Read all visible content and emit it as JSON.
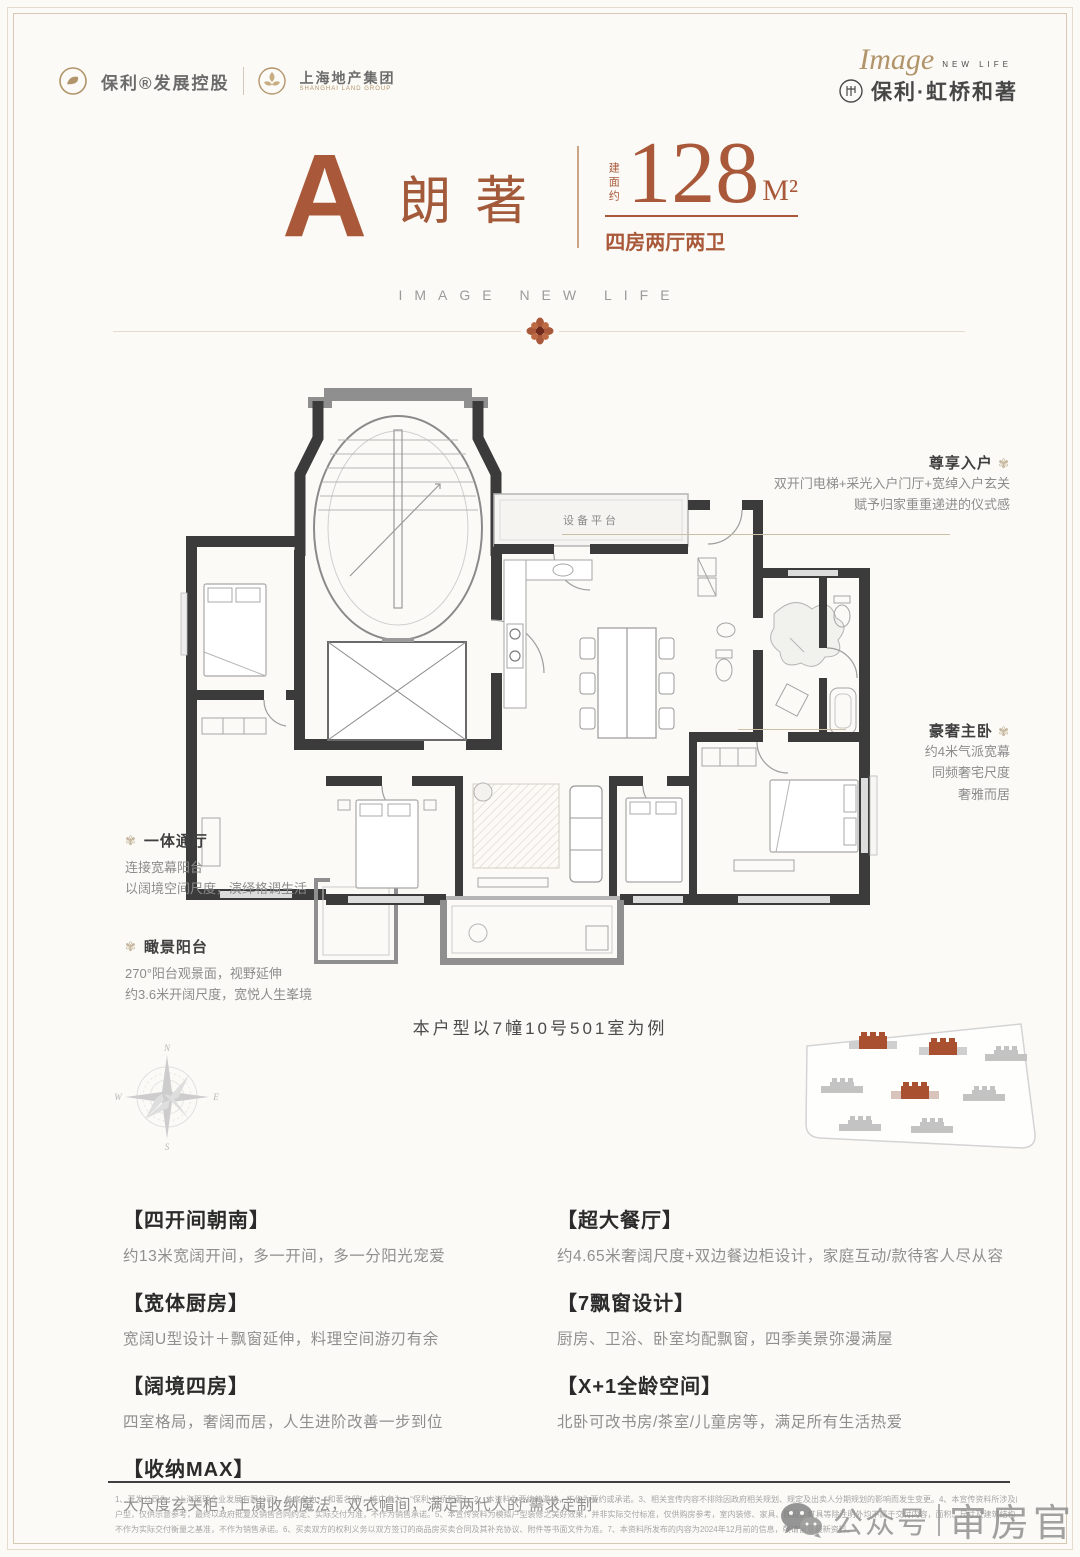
{
  "colors": {
    "accent": "#a9593a",
    "ink": "#3a3a3a",
    "muted": "#8f8f8f",
    "gold": "#b2946a",
    "wall": "#3b3b3b"
  },
  "icons": {
    "callout_bullet": "✾",
    "poly_logo_icon": "gold-swirl-circle",
    "shanghai_land_icon": "gold-flower-circle",
    "project_logo_icon": "ring-seal",
    "wechat_icon": "chat-bubbles",
    "compass_icon": "compass-rose",
    "divider_flower_icon": "rosette"
  },
  "header": {
    "brand1": "保利®发展控股",
    "brand2": "上海地产集团",
    "brand2_sub": "SHANGHAI LAND GROUP",
    "logo_script": "Image",
    "logo_tag": "NEW LIFE",
    "project_name": "保利·虹桥和著"
  },
  "title": {
    "unit_letter": "A",
    "unit_name": "朗著",
    "area_label": "建面约",
    "area_value": "128",
    "area_unit": "M²",
    "room_spec": "四房两厅两卫",
    "slogan": "IMAGE NEW LIFE"
  },
  "floorplan": {
    "platform_label": "设备平台",
    "caption": "本户型以7幢10号501室为例"
  },
  "callouts": {
    "entry": {
      "title": "尊享入户",
      "line1": "双开门电梯+采光入户门厅+宽绰入户玄关",
      "line2": "赋予归家重重递进的仪式感"
    },
    "master": {
      "title": "豪奢主卧",
      "line1": "约4米气派宽幕",
      "line2": "同频奢宅尺度",
      "line3": "奢雅而居"
    },
    "hall": {
      "title": "一体通厅",
      "line1": "连接宽幕阳台",
      "line2": "以阔境空间尺度，演绎格调生活"
    },
    "balcony": {
      "title": "瞰景阳台",
      "line1": "270°阳台观景面，视野延伸",
      "line2": "约3.6米开阔尺度，宽悦人生峯境"
    }
  },
  "compass": {
    "n": "N",
    "e": "E",
    "s": "S",
    "w": "W"
  },
  "features": {
    "left": [
      {
        "title": "【四开间朝南】",
        "desc": "约13米宽阔开间，多一开间，多一分阳光宠爱"
      },
      {
        "title": "【宽体厨房】",
        "desc": "宽阔U型设计＋飘窗延伸，料理空间游刃有余"
      },
      {
        "title": "【阔境四房】",
        "desc": "四室格局，奢阔而居，人生进阶改善一步到位"
      },
      {
        "title": "【收纳MAX】",
        "desc": "大尺度玄关柜，上演收纳魔法，双衣帽间，满足两代人的“需求定制”"
      }
    ],
    "right": [
      {
        "title": "【超大餐厅】",
        "desc": "约4.65米奢阔尺度+双边餐边柜设计，家庭互动/款待客人尽从容"
      },
      {
        "title": "【7飘窗设计】",
        "desc": "厨房、卫浴、卧室均配飘窗，四季美景弥漫满屋"
      },
      {
        "title": "【X+1全龄空间】",
        "desc": "北卧可改书房/茶室/儿童房等，满足所有生活热爱"
      }
    ]
  },
  "disclaimer": {
    "line1": "1、开发公司为：“上海琨理企业发展有限公司”，备案名为：“和著名邸”，推广名为：“保利·虹桥和著”。2、本资料为要约的邀请，不作为要约或承诺。3、相关宣传内容不排除因政府相关规划、规定及出卖人分期规划的影响而发生变更。4、本宣传资料所涉及的",
    "line2": "户型，仅供示意参考，最终以政府批复及销售合同约定、实际交付为准，不作为销售承诺。5、本宣传资料为模拟户型装修之美好效果，并非实际交付标准，仅供购房参考，室内装修、家具、陈设、灯具等除注明外均不属于交付内容，面积、尺寸及建筑结构",
    "line3": "不作为实际交付衡量之基准，不作为销售承诺。6、买卖双方的权利义务以双方签订的商品房买卖合同及其补充协议、附件等书面文件为准。7、本资料所发布的内容为2024年12月前的信息，敬请留意最新资料。"
  },
  "watermark": {
    "channel": "公众号",
    "name": "审房官"
  }
}
